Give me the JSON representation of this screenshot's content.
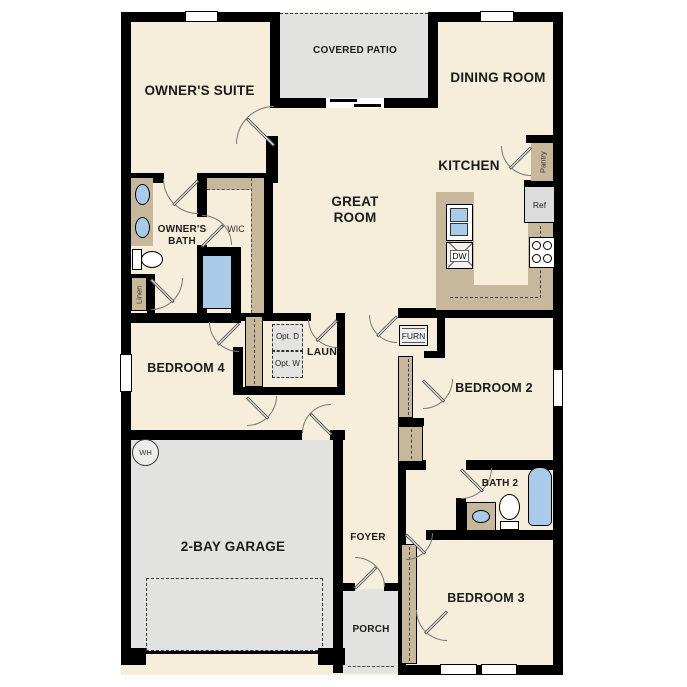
{
  "floorplan": {
    "rooms": {
      "owners_suite": "OWNER'S SUITE",
      "covered_patio": "COVERED PATIO",
      "dining_room": "DINING ROOM",
      "great_room": "GREAT ROOM",
      "kitchen": "KITCHEN",
      "owners_bath": "OWNER'S BATH",
      "wic": "WIC",
      "bedroom_4": "BEDROOM 4",
      "bedroom_2": "BEDROOM 2",
      "bedroom_3": "BEDROOM 3",
      "bath_2": "BATH 2",
      "laundry": "LAUN",
      "garage": "2-BAY GARAGE",
      "foyer": "FOYER",
      "porch": "PORCH"
    },
    "fixtures": {
      "pantry": "Pantry",
      "linen": "Linen",
      "ref": "Ref",
      "dw": "DW",
      "opt_d": "Opt. D",
      "opt_w": "Opt. W",
      "furn": "FURN",
      "wh": "WH"
    },
    "colors": {
      "floor": "#f6eddb",
      "wall": "#000000",
      "cabinet_tan": "#c7b79b",
      "fixture_blue": "#a9cbe9",
      "concrete_grey": "#e2e2e0",
      "appliance_grey": "#dcdcdc"
    }
  }
}
